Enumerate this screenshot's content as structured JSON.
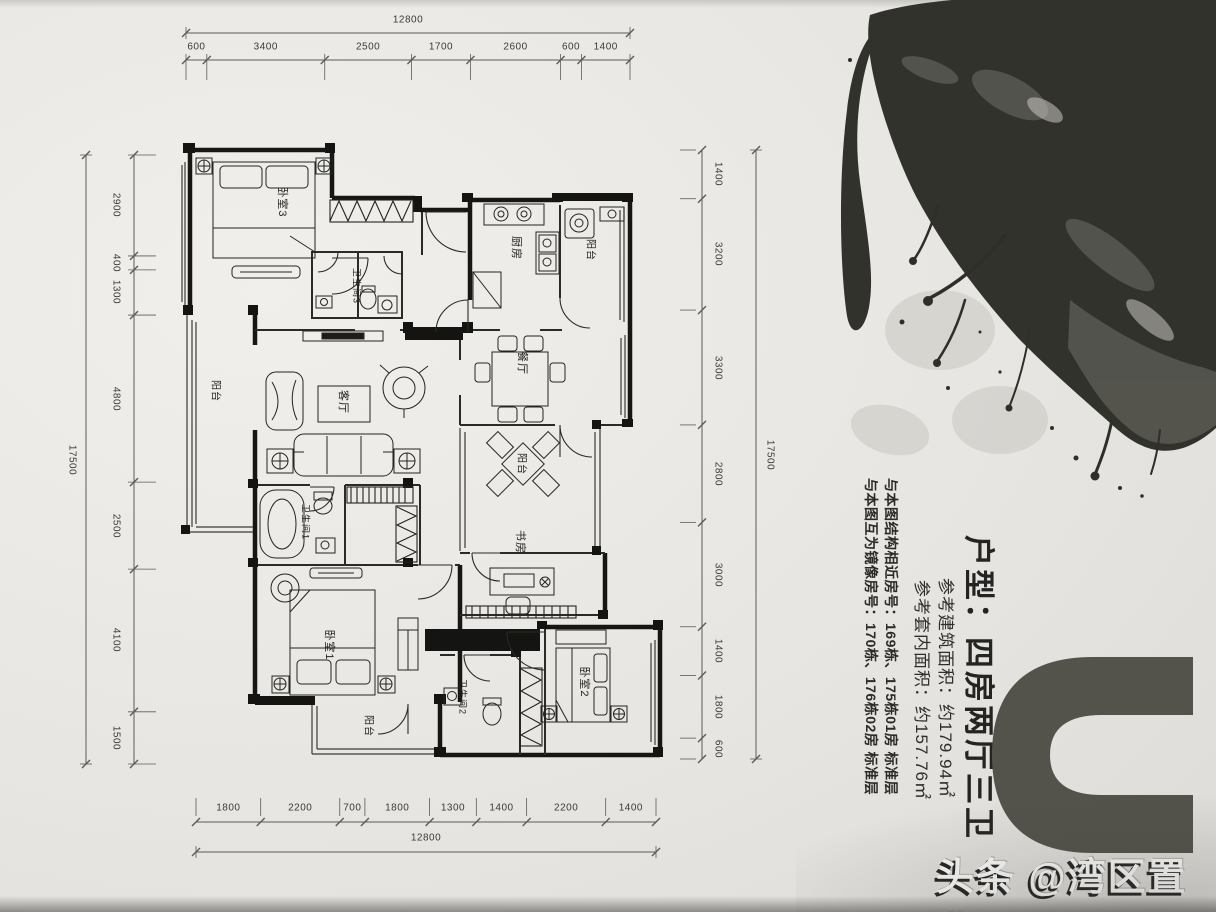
{
  "info_panel": {
    "title": "户型：四房两厅三卫",
    "line_build_area": "参考建筑面积：约179.94㎡",
    "line_inner_area": "参考套内面积：约157.76㎡",
    "line_similar": "与本图结构相近房号：169栋、175栋01房 标准层",
    "line_mirror": "与本图互为镜像房号：170栋、176栋02房 标准层"
  },
  "watermark": {
    "text": "头条 @湾区置业"
  },
  "big_letter": {
    "text": "U",
    "color": "#53534b"
  },
  "dimensions": {
    "top": {
      "total": "12800",
      "segments": [
        "600",
        "3400",
        "2500",
        "1700",
        "2600",
        "600",
        "1400"
      ]
    },
    "bottom": {
      "total": "12800",
      "segments": [
        "1800",
        "2200",
        "700",
        "1800",
        "1300",
        "1400",
        "2200",
        "1400"
      ]
    },
    "left": {
      "total": "17500",
      "segments": [
        "2900",
        "400",
        "1300",
        "4800",
        "2500",
        "4100",
        "1500"
      ]
    },
    "right": {
      "total": "17500",
      "segments": [
        "1400",
        "3200",
        "3300",
        "2800",
        "3000",
        "1400",
        "1800",
        "600"
      ]
    }
  },
  "room_labels": [
    {
      "label": "卧室3",
      "x": 283,
      "y": 202,
      "fs": 11
    },
    {
      "label": "卫生间3",
      "x": 357,
      "y": 286,
      "fs": 9
    },
    {
      "label": "厨房",
      "x": 517,
      "y": 248,
      "fs": 11
    },
    {
      "label": "阳台",
      "x": 592,
      "y": 250,
      "fs": 10
    },
    {
      "label": "餐厅",
      "x": 523,
      "y": 363,
      "fs": 11
    },
    {
      "label": "客厅",
      "x": 344,
      "y": 402,
      "fs": 11
    },
    {
      "label": "阳台",
      "x": 217,
      "y": 391,
      "fs": 10
    },
    {
      "label": "阳台",
      "x": 523,
      "y": 464,
      "fs": 10
    },
    {
      "label": "书房",
      "x": 521,
      "y": 542,
      "fs": 11
    },
    {
      "label": "卫生间1",
      "x": 306,
      "y": 522,
      "fs": 9
    },
    {
      "label": "卧室1",
      "x": 330,
      "y": 645,
      "fs": 11
    },
    {
      "label": "卫生间2",
      "x": 463,
      "y": 697,
      "fs": 9
    },
    {
      "label": "阳台",
      "x": 370,
      "y": 726,
      "fs": 10
    },
    {
      "label": "卧室2",
      "x": 585,
      "y": 682,
      "fs": 11
    }
  ],
  "colors": {
    "paper": "#e8e6e2",
    "wall": "#161614",
    "dim_line": "#5c5b57",
    "ink": "#32322d"
  }
}
